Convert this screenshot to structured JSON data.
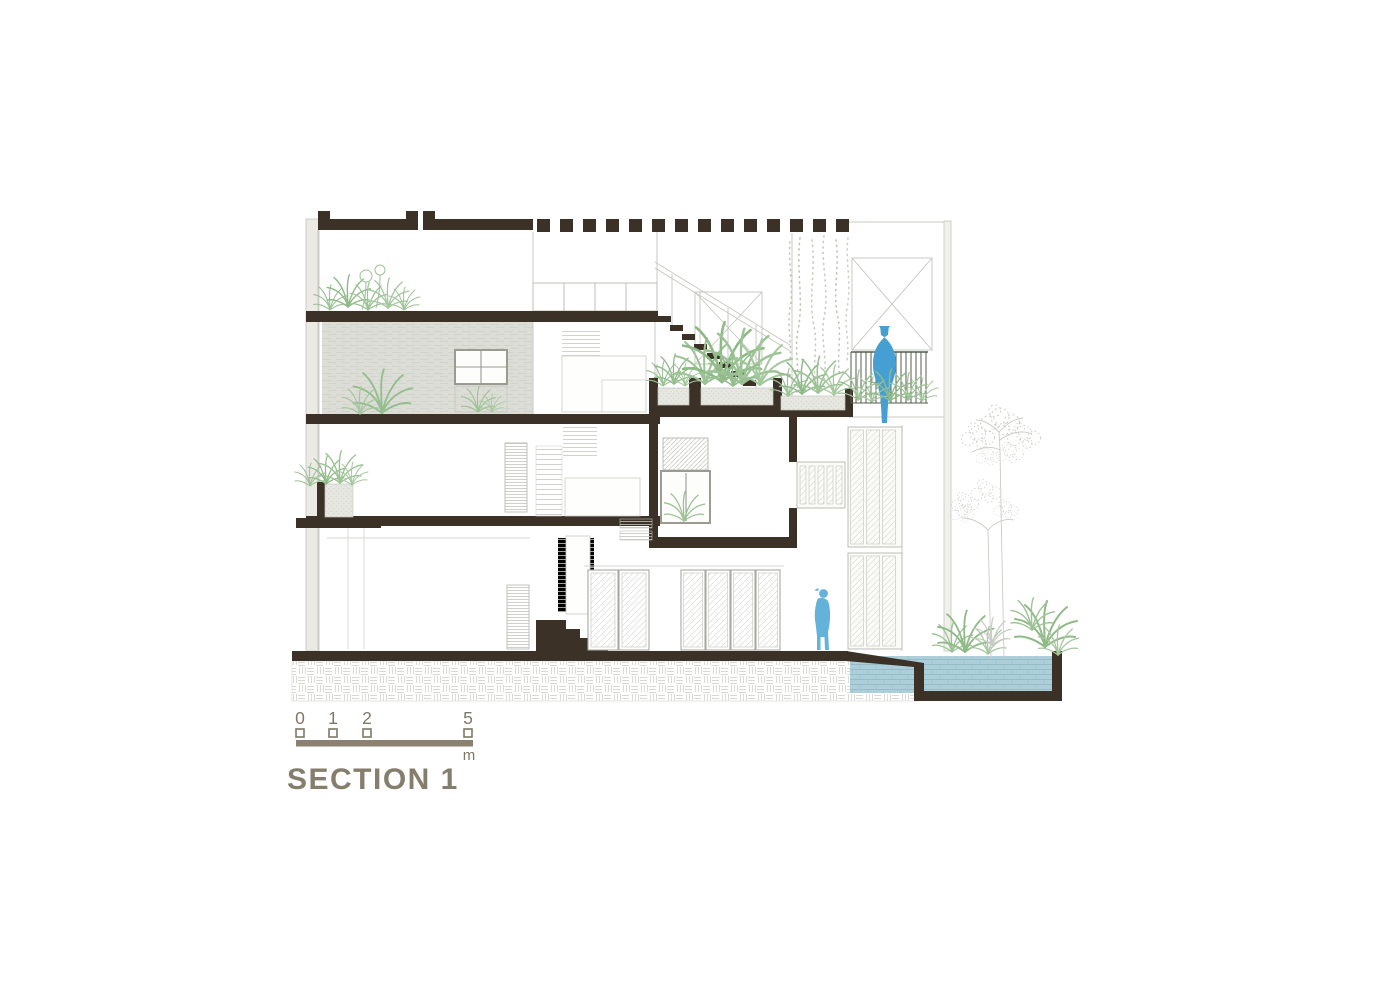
{
  "title": "SECTION 1",
  "scale_bar": {
    "ticks": [
      "0",
      "1",
      "2",
      "5"
    ],
    "unit": "m"
  },
  "palette": {
    "section_cut_dark": "#3b3127",
    "annotation_brown": "#867e6d",
    "vegetation_green": "#9cc295",
    "water_blue": "#accfd9",
    "figure_blue": "#4f9fd2",
    "sketch_gray": "#cbcbc5",
    "textured_wall_gray": "#dcddd7"
  },
  "figures": {
    "balcony_figure": "abstract-person-blue",
    "ground_figure": "standing-person-blue"
  }
}
